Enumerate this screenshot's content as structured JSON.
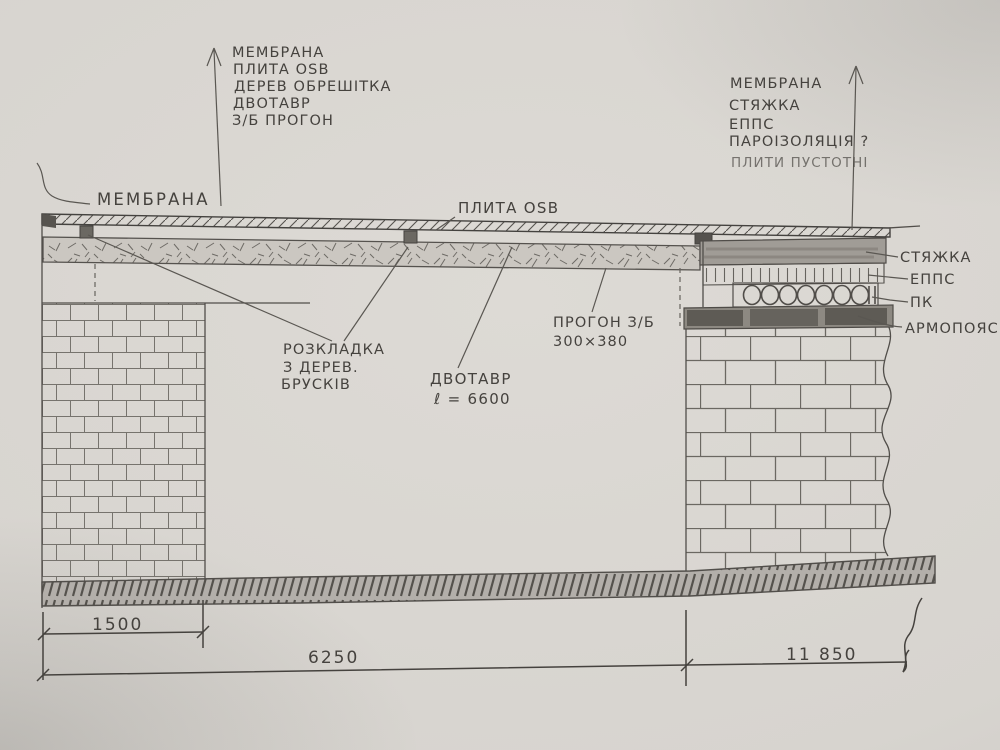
{
  "palette": {
    "paper": "#d7d4cf",
    "pencil_ink": "#45423e"
  },
  "legend_left": {
    "lines": [
      "МЕМБРАНА",
      "ПЛИТА OSB",
      "ДЕРЕВ ОБРЕШІТКА",
      "ДВОТАВР",
      "З/Б ПРОГОН"
    ]
  },
  "legend_right": {
    "lines": [
      "МЕМБРАНА",
      "СТЯЖКА",
      "ЕППС",
      "ПАРОІЗОЛЯЦІЯ ?",
      "ПЛИТИ ПУСТОТНІ"
    ]
  },
  "labels": {
    "membrane": "МЕМБРАНА",
    "osb_plate": "ПЛИТА OSB",
    "battens": {
      "l1": "РОЗКЛАДКА",
      "l2": "З ДЕРЕВ.",
      "l3": "БРУСКІВ"
    },
    "ibeam": {
      "l1": "ДВОТАВР",
      "l2": "ℓ = 6600"
    },
    "purlin": {
      "l1": "ПРОГОН З/Б",
      "l2": "300×380"
    },
    "screed": "СТЯЖКА",
    "epps": "ЕППС",
    "hollow_slab": "ПК",
    "armo_belt": "АРМОПОЯС"
  },
  "dimensions": {
    "left_wall": "1500",
    "span": "6250",
    "right_span": "11 850"
  }
}
